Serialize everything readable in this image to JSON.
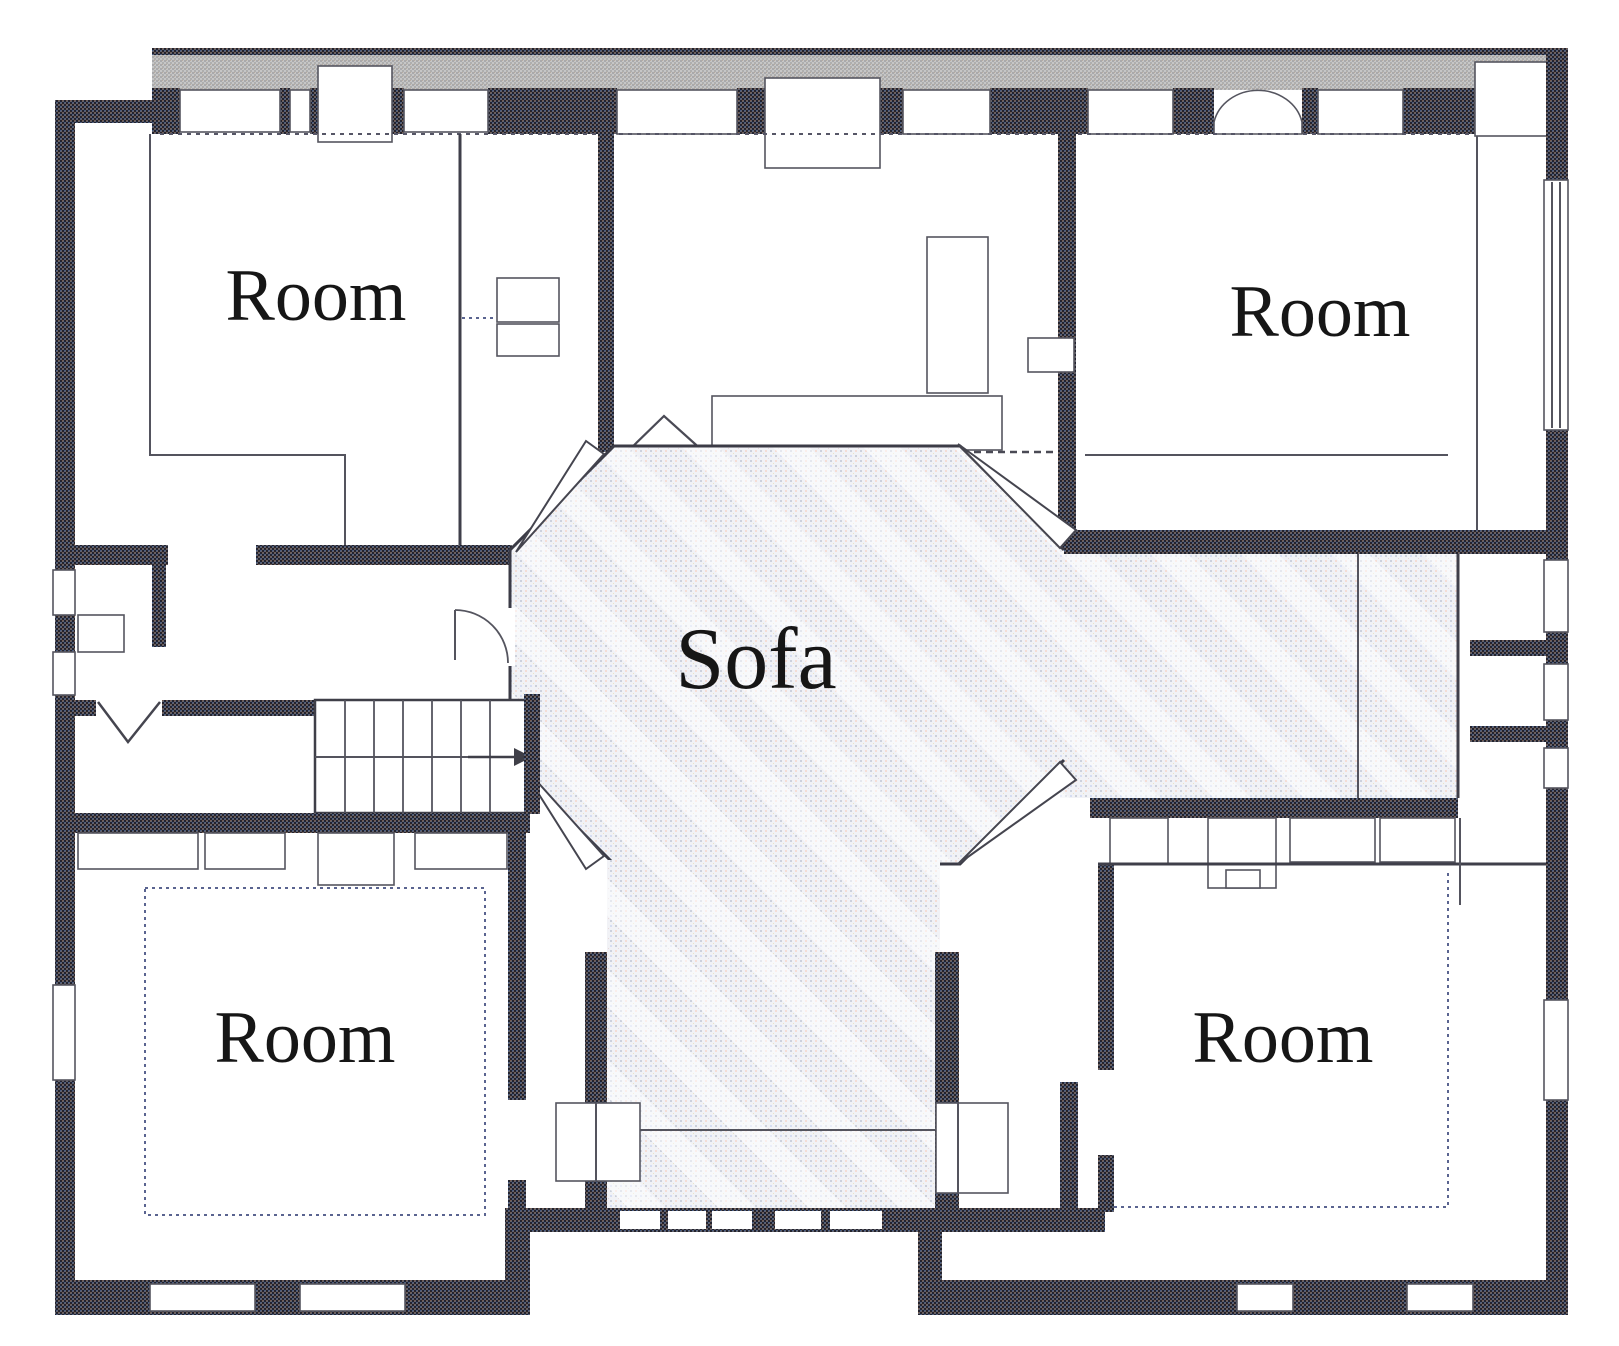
{
  "floor_plan": {
    "labels": {
      "room_top_left": "Room",
      "room_top_right": "Room",
      "room_bottom_left": "Room",
      "room_bottom_right": "Room",
      "hall": "Sofa"
    },
    "colors": {
      "background": "#ffffff",
      "wall_dark": "#41414c",
      "wall_gray": "#bfbfbf",
      "floor_hatch": "#f1f2f6",
      "line": "#54545e",
      "text": "#161616"
    }
  }
}
